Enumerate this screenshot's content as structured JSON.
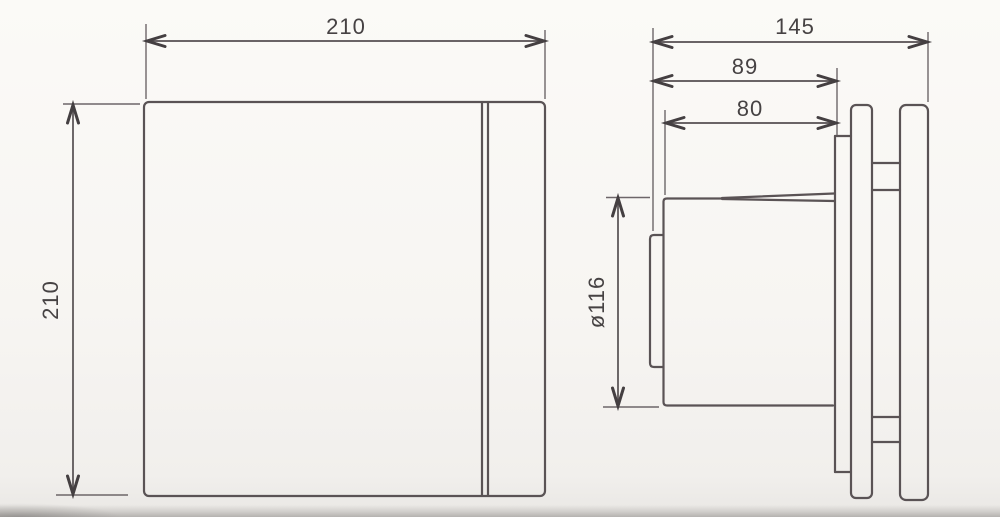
{
  "meta": {
    "title": "Extractor fan dimensional drawing",
    "units": "mm"
  },
  "front_view": {
    "name": "front view (square cover)",
    "width_label": "210",
    "height_label": "210"
  },
  "side_view": {
    "name": "side view (body, mounting plate, cover and duct spigot)",
    "overall_depth_label": "145",
    "body_depth_label": "89",
    "duct_length_label": "80",
    "duct_diameter_label": "ø116"
  }
}
